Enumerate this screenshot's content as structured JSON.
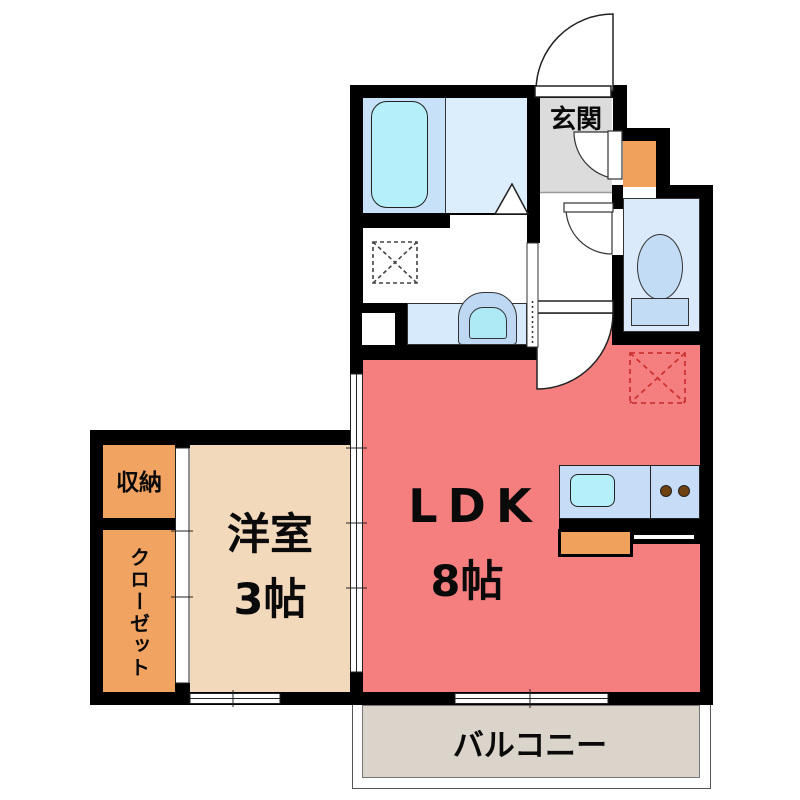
{
  "rooms": {
    "genkan": {
      "label": "玄関"
    },
    "ldk": {
      "label": "LDK",
      "size": "8帖"
    },
    "western_room": {
      "label": "洋室",
      "size": "3帖"
    },
    "storage": {
      "label": "収納"
    },
    "closet": {
      "label": "クローゼット"
    },
    "balcony": {
      "label": "バルコニー"
    }
  },
  "fixtures": [
    "bathtub",
    "bathroom-folding-door",
    "washing-machine-space",
    "washbasin",
    "toilet",
    "shoe-cabinet",
    "entry-door",
    "hallway-door",
    "toilet-door",
    "ldk-door",
    "kitchen-counter",
    "kitchen-sink",
    "stove-burners",
    "refrigerator-space",
    "sliding-door-western-room",
    "sliding-door-closet",
    "window-western-room",
    "balcony-window",
    "sliding-door-washroom"
  ],
  "colors": {
    "wall": "#000000",
    "ldk_floor": "#F57F7F",
    "western_room_floor": "#F3D9BC",
    "storage_closet": "#F1A361",
    "entrance_floor": "#DCDCDC",
    "bathroom_tub_zone": "#C7E1F8",
    "bathroom_floor": "#DCEDFC",
    "toilet_floor": "#DBEAFB",
    "fixture_blue": "#C7DCF7",
    "water_cyan": "#B4EFFA",
    "balcony_floor": "#DAD4CB",
    "appliance_dashed_red": "#CC3333"
  }
}
